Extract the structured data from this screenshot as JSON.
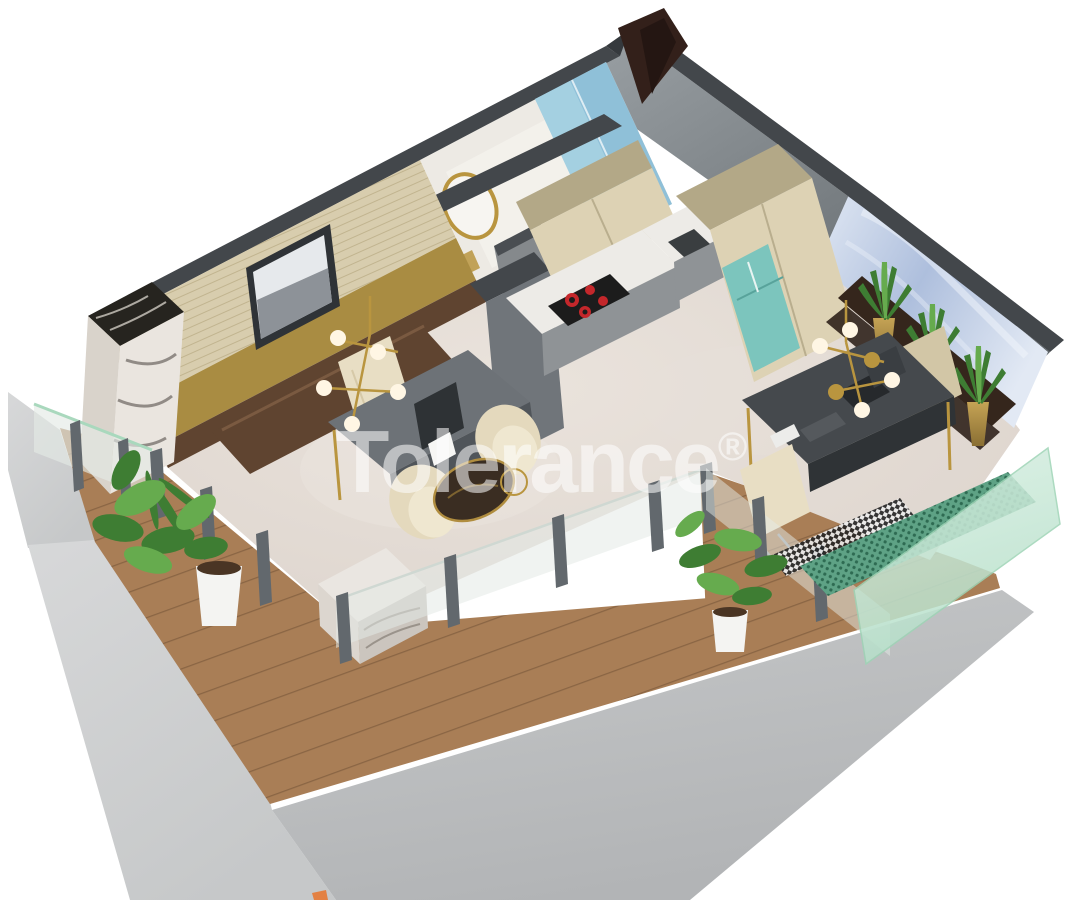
{
  "watermark": {
    "brand": "Tolerance",
    "symbol": "®"
  },
  "scene": {
    "type": "3d-floor-plan-render",
    "rooms": [
      "bathroom",
      "kitchen",
      "living-area",
      "home-office",
      "terrace-deck"
    ],
    "objects": [
      "gold-mirror",
      "shower-cabin",
      "cooktop",
      "fridge",
      "entry-door",
      "framed-artwork",
      "marble-column",
      "work-desk",
      "office-desk",
      "laptop",
      "armchairs",
      "coffee-table",
      "chandelier",
      "wall-shelf",
      "plant-vases",
      "potted-plants",
      "glass-balustrade",
      "wood-deck",
      "concrete-slab"
    ]
  },
  "colors": {
    "white_bg": "#ffffff",
    "slab_light": "#d7d8d9",
    "slab_mid": "#c6c8c9",
    "slab_dark": "#b2b4b6",
    "deck": "#a97e56",
    "deck_line": "#8a6544",
    "floor": "#dbd2cb",
    "floor_light": "#eae3dc",
    "wall_dark": "#43474b",
    "wall_dark2": "#35393d",
    "gray_face_light": "#9aa0a4",
    "gray_face_dark": "#5b6165",
    "slat": "#d8cdae",
    "slat_line": "#c1b48f",
    "gold_wall": "#a98c42",
    "wood_dark": "#5f4430",
    "wardrobe_brown": "#33201a",
    "art_frame": "#2f3337",
    "art_sky": "#e6e9ec",
    "art_hills": "#8d9298",
    "marble_top": "#26241f",
    "marble_face": "#eae5df",
    "marble_vein": "#6b655f",
    "bath_wall": "#edeae4",
    "bath_wall_light": "#f7f5f0",
    "shower_blue": "#8fc0d8",
    "shower_blue_light": "#b7dcea",
    "door_gray": "#85898c",
    "cab_upper": "#ddd2b4",
    "cab_top": "#b3a887",
    "cab_gray": "#8f9396",
    "counter": "#edebe7",
    "cooktop": "#1c1c1c",
    "burner": "#c4272b",
    "fridge": "#7cc5bd",
    "fridge_dark": "#58a39b",
    "sink": "#3a3e40",
    "partition": "#70757a",
    "partition_dark": "#4a4e52",
    "desk_gray": "#6d7277",
    "desk_gray_dark": "#50555a",
    "desk_dark": "#45494d",
    "desk_dark2": "#2f3336",
    "chair_cream": "#e8dec4",
    "chair_tan": "#d2c6a6",
    "table_dark": "#3a2d22",
    "gold": "#b9953f",
    "globe": "#fff6e4",
    "shelf_brown": "#35261c",
    "plant_dark": "#3e7d33",
    "plant_light": "#66ab4e",
    "pot_white": "#f4f4f2",
    "soil": "#4a3524",
    "glass": "#e3eae5",
    "glass_edge": "#a9d8bd",
    "post_gray": "#62686d",
    "green_panel": "#5ea285",
    "green_dot": "#2e6b52",
    "green_glass_a": "#daf0e4",
    "green_glass_b": "#b4dfc8",
    "checker_dark": "#222222",
    "checker_light": "#ececec",
    "blue_wall": "#aebfdd",
    "blue_wall_light": "#e2e9f4",
    "watermark": "#ffffff",
    "artifact_orange": "#e8742c"
  }
}
